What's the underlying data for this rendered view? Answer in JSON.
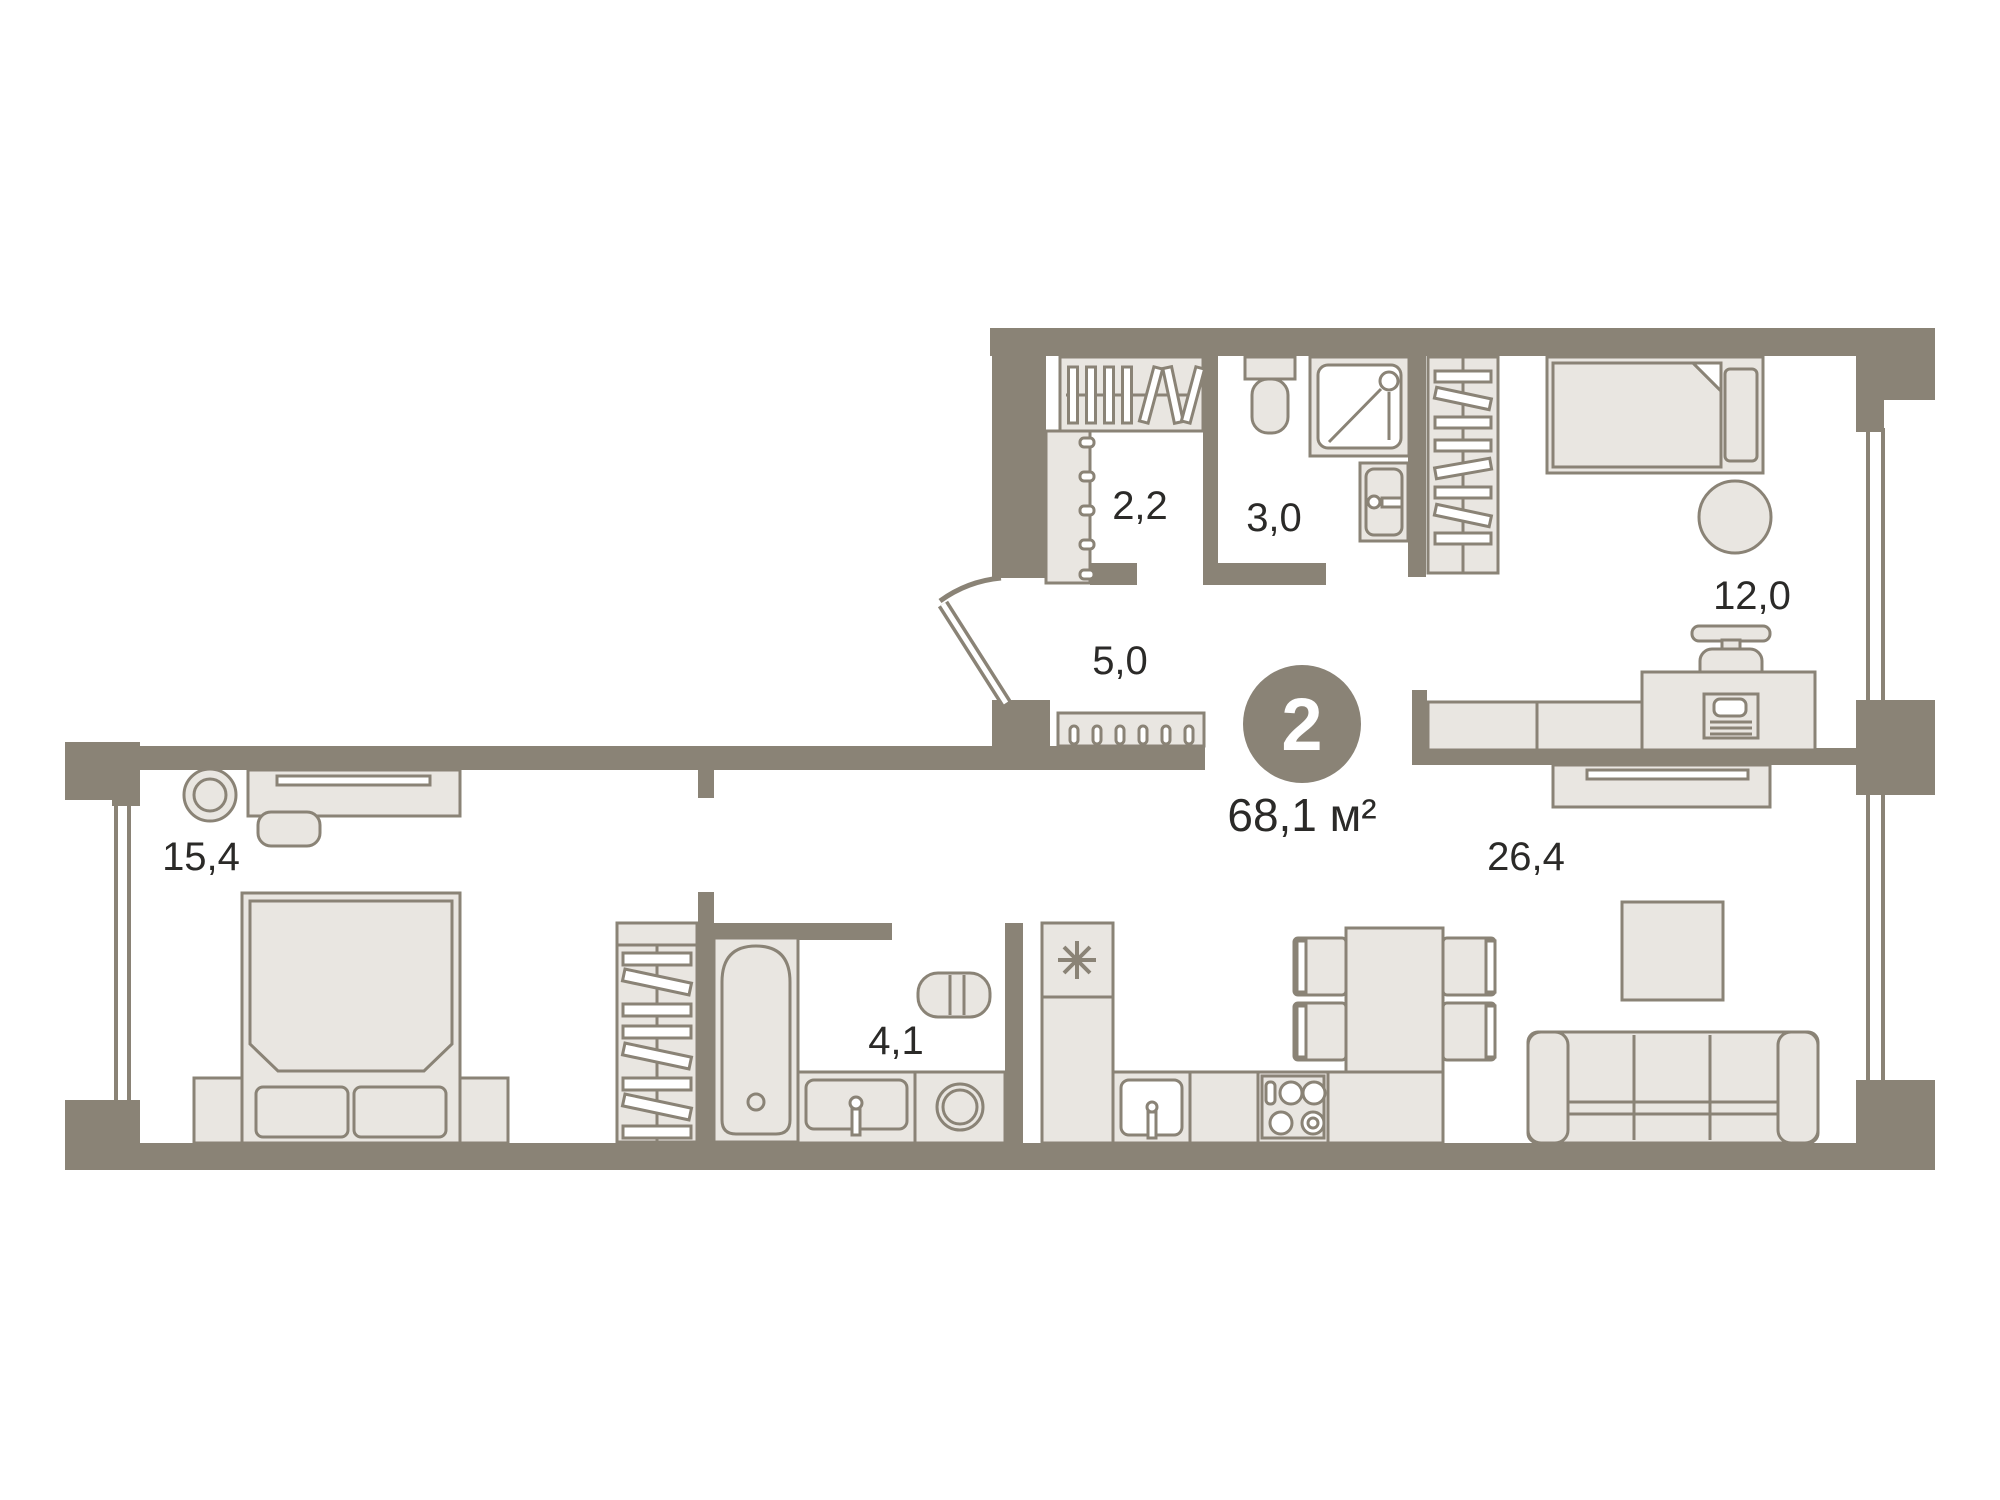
{
  "badge": {
    "rooms_count": "2",
    "total_area": "68,1 м²"
  },
  "room_labels": {
    "closet": "2,2",
    "wc": "3,0",
    "hallway": "5,0",
    "bedroom": "12,0",
    "master_bedroom": "15,4",
    "bathroom": "4,1",
    "living_kitchen": "26,4"
  },
  "colors": {
    "background": "#ffffff",
    "wall": "#8a8376",
    "furniture_fill": "#e9e6e1",
    "outline": "#8a8376",
    "text": "#2b2a28",
    "badge_fill": "#8a8376",
    "badge_text": "#ffffff"
  }
}
